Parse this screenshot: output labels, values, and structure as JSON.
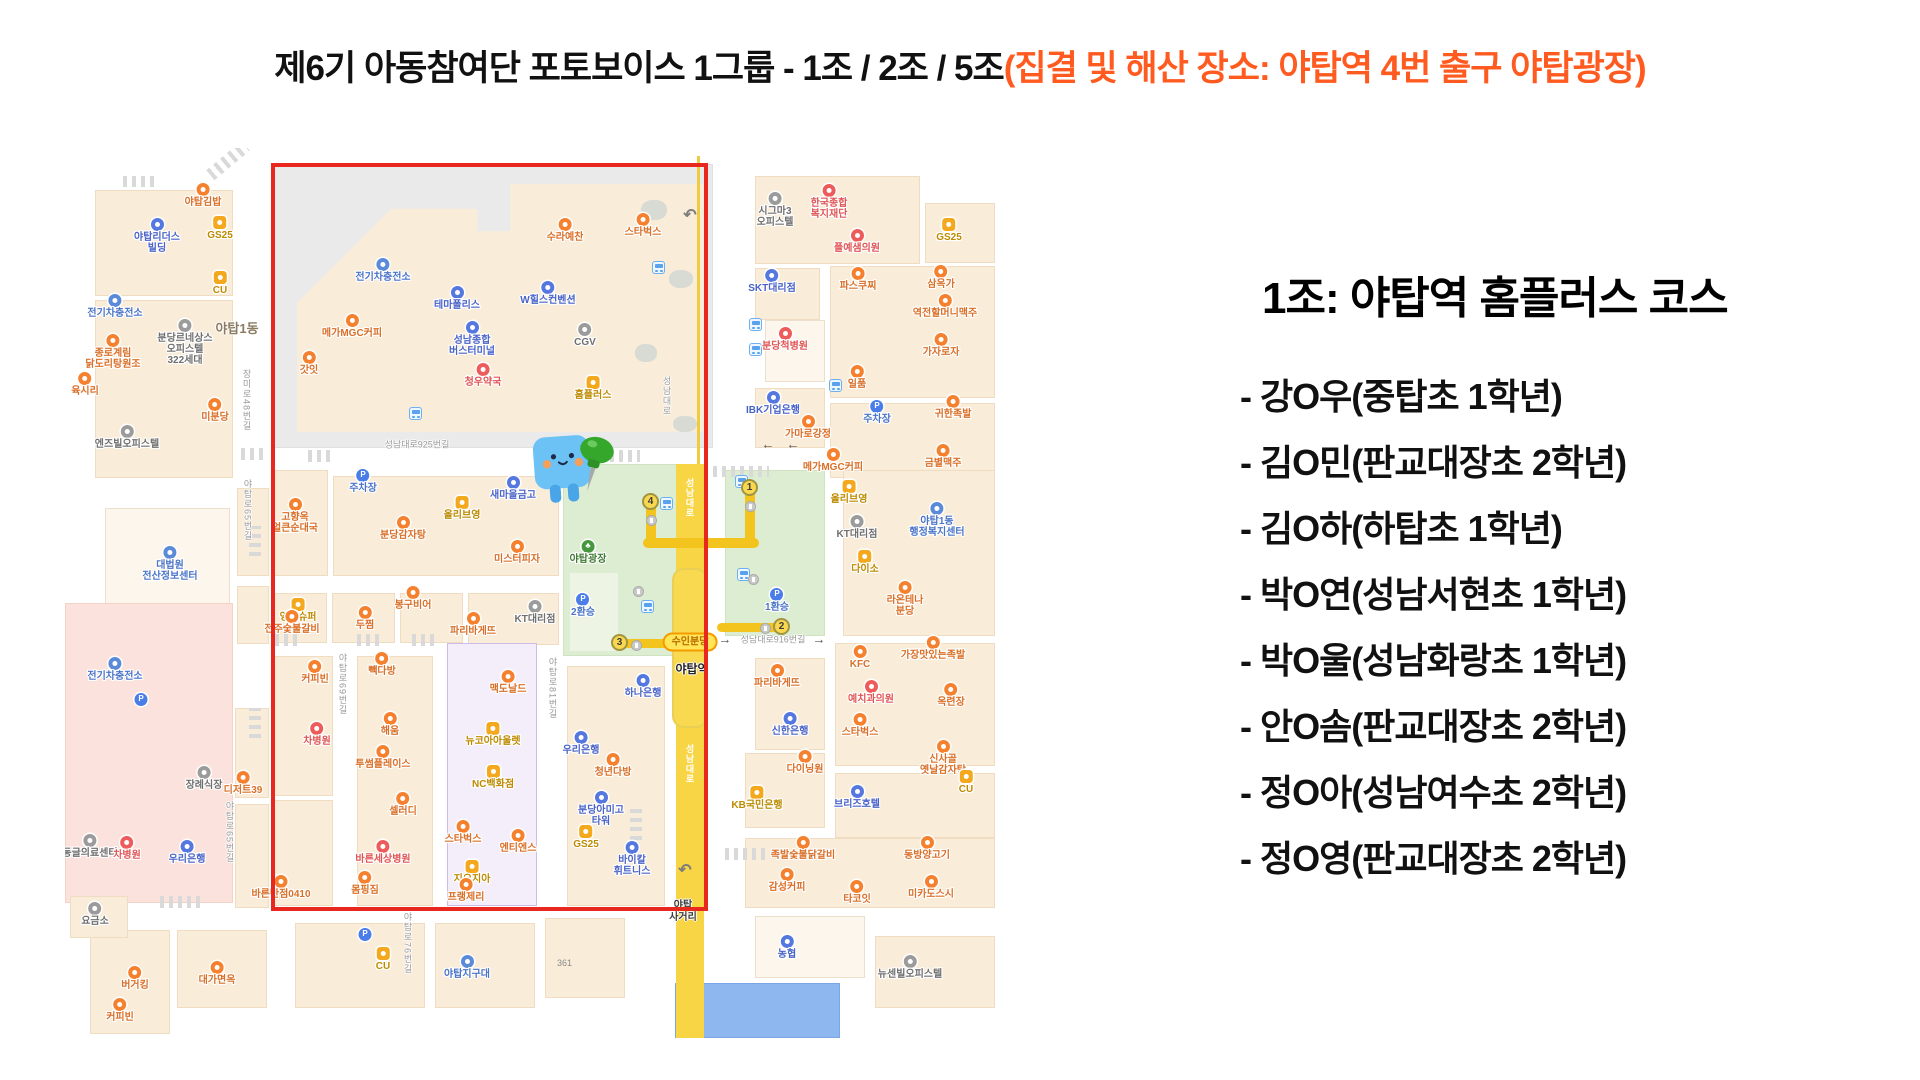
{
  "slide": {
    "title_black": "제6기 아동참여단 포토보이스 1그룹 - 1조 / 2조 / 5조",
    "title_orange": "(집결 및 해산 장소: 야탑역 4번 출구 야탑광장)",
    "title_orange_color": "#ff5a1f"
  },
  "panel": {
    "heading": "1조: 야탑역 홈플러스 코스",
    "members": [
      "- 강O우(중탑초 1학년)",
      "- 김O민(판교대장초 2학년)",
      "- 김O하(하탑초 1학년)",
      "- 박O연(성남서현초 1학년)",
      "- 박O울(성남화랑초 1학년)",
      "- 안O솜(판교대장초 2학년)",
      "- 정O아(성남여수초 2학년)",
      "- 정O영(판교대장초 2학년)"
    ]
  },
  "map": {
    "colors": {
      "highlight_box_red": "#e8281e",
      "road_yellow": "#f7d544",
      "route_yellow": "#f2c41d",
      "plaza_green": "#dcedd2",
      "block_beige": "#f9ecd9"
    },
    "station": {
      "line_badge": "수인분당",
      "name": "야탑역",
      "road_name": "성남대로"
    },
    "exits": [
      {
        "n": "4",
        "x": 586,
        "y": 354
      },
      {
        "n": "1",
        "x": 685,
        "y": 340
      },
      {
        "n": "3",
        "x": 555,
        "y": 495
      },
      {
        "n": "2",
        "x": 717,
        "y": 479
      }
    ],
    "route_segments": [
      [
        581,
        352,
        10,
        48
      ],
      [
        680,
        338,
        10,
        62
      ],
      [
        578,
        390,
        116,
        10
      ],
      [
        558,
        491,
        56,
        9
      ],
      [
        652,
        475,
        64,
        9
      ]
    ],
    "roads": [
      {
        "label": "성남대로925번길",
        "x": 352,
        "y": 296,
        "v": false
      },
      {
        "label": "성남대로916번길",
        "x": 708,
        "y": 491,
        "v": false
      },
      {
        "label": "장미로48번길",
        "x": 182,
        "y": 252,
        "v": true
      },
      {
        "label": "야탑로65번길",
        "x": 183,
        "y": 362,
        "v": true
      },
      {
        "label": "야탑로65번길",
        "x": 165,
        "y": 684,
        "v": true
      },
      {
        "label": "야탑로69번길",
        "x": 278,
        "y": 536,
        "v": true
      },
      {
        "label": "야탑로81번길",
        "x": 488,
        "y": 540,
        "v": true
      },
      {
        "label": "야탑로76번길",
        "x": 343,
        "y": 795,
        "v": true
      },
      {
        "label": "성남대로",
        "x": 602,
        "y": 248,
        "v": true
      }
    ],
    "arrows": [
      {
        "t": "←",
        "x": 703,
        "y": 296
      },
      {
        "t": "←",
        "x": 728,
        "y": 296
      },
      {
        "t": "→",
        "x": 660,
        "y": 491
      },
      {
        "t": "→",
        "x": 754,
        "y": 491
      }
    ],
    "dong_labels": [
      {
        "label": "야탑1동",
        "x": 172,
        "y": 170
      }
    ],
    "crossing_labels": [
      {
        "label": "야탑\n사거리",
        "x": 618,
        "y": 752
      }
    ],
    "number_labels": [
      {
        "label": "361",
        "x": 492,
        "y": 810
      }
    ],
    "pois": [
      {
        "label": "야탑김밥",
        "x": 138,
        "y": 49,
        "c": "food"
      },
      {
        "label": "야탑리더스\n빌딩",
        "x": 92,
        "y": 84,
        "c": "bank"
      },
      {
        "label": "GS25",
        "x": 155,
        "y": 82,
        "c": "conv"
      },
      {
        "label": "CU",
        "x": 155,
        "y": 137,
        "c": "conv"
      },
      {
        "label": "전기차충전소",
        "x": 50,
        "y": 160,
        "c": "pub"
      },
      {
        "label": "분당르네상스\n오피스텔\n322세대",
        "x": 120,
        "y": 185,
        "c": "grayp"
      },
      {
        "label": "종로계림\n닭도리탕원조",
        "x": 48,
        "y": 200,
        "c": "food"
      },
      {
        "label": "육시리",
        "x": 20,
        "y": 238,
        "c": "food"
      },
      {
        "label": "미분당",
        "x": 150,
        "y": 264,
        "c": "food"
      },
      {
        "label": "엔즈빌오피스텔",
        "x": 62,
        "y": 291,
        "c": "grayp"
      },
      {
        "label": "대법원\n전산정보센터",
        "x": 105,
        "y": 412,
        "c": "pub"
      },
      {
        "label": "전기차충전소",
        "x": 50,
        "y": 523,
        "c": "pub"
      },
      {
        "label": "",
        "x": 76,
        "y": 559,
        "c": "park",
        "g": "P"
      },
      {
        "label": "장례식장",
        "x": 139,
        "y": 632,
        "c": "grayp"
      },
      {
        "label": "동글의료센터",
        "x": 25,
        "y": 700,
        "c": "grayp"
      },
      {
        "label": "차병원",
        "x": 62,
        "y": 702,
        "c": "hosp"
      },
      {
        "label": "우리은행",
        "x": 122,
        "y": 706,
        "c": "bank"
      },
      {
        "label": "요금소",
        "x": 30,
        "y": 768,
        "c": "grayp"
      },
      {
        "label": "버거킹",
        "x": 70,
        "y": 832,
        "c": "food"
      },
      {
        "label": "대가면옥",
        "x": 152,
        "y": 827,
        "c": "food"
      },
      {
        "label": "커피빈",
        "x": 55,
        "y": 864,
        "c": "food"
      },
      {
        "label": "수라예찬",
        "x": 500,
        "y": 84,
        "c": "food"
      },
      {
        "label": "전기차충전소",
        "x": 318,
        "y": 124,
        "c": "pub"
      },
      {
        "label": "테마폴리스",
        "x": 392,
        "y": 152,
        "c": "bank"
      },
      {
        "label": "W힐스컨벤션",
        "x": 483,
        "y": 147,
        "c": "bank"
      },
      {
        "label": "메가MGC커피",
        "x": 287,
        "y": 180,
        "c": "food"
      },
      {
        "label": "성남종합\n버스터미널",
        "x": 407,
        "y": 187,
        "c": "bank"
      },
      {
        "label": "CGV",
        "x": 520,
        "y": 189,
        "c": "grayp"
      },
      {
        "label": "갓잇",
        "x": 244,
        "y": 217,
        "c": "food"
      },
      {
        "label": "청우약국",
        "x": 418,
        "y": 229,
        "c": "hosp"
      },
      {
        "label": "홈플러스",
        "x": 528,
        "y": 242,
        "c": "conv"
      },
      {
        "label": "스타벅스",
        "x": 578,
        "y": 79,
        "c": "food"
      },
      {
        "label": "주차장",
        "x": 298,
        "y": 335,
        "c": "park",
        "g": "P"
      },
      {
        "label": "새마을금고",
        "x": 448,
        "y": 342,
        "c": "bank"
      },
      {
        "label": "올리브영",
        "x": 397,
        "y": 362,
        "c": "conv"
      },
      {
        "label": "고향옥\n얼큰순대국",
        "x": 230,
        "y": 364,
        "c": "food"
      },
      {
        "label": "분당감자탕",
        "x": 338,
        "y": 382,
        "c": "food"
      },
      {
        "label": "미스터피자",
        "x": 452,
        "y": 406,
        "c": "food"
      },
      {
        "label": "야탑광장",
        "x": 523,
        "y": 406,
        "c": "plaza",
        "g": "♣"
      },
      {
        "label": "2환승",
        "x": 518,
        "y": 459,
        "c": "park",
        "g": "P"
      },
      {
        "label": "KT대리점",
        "x": 470,
        "y": 466,
        "c": "grayp"
      },
      {
        "label": "영진슈퍼",
        "x": 233,
        "y": 464,
        "c": "conv"
      },
      {
        "label": "봉구비어",
        "x": 348,
        "y": 452,
        "c": "food"
      },
      {
        "label": "전주숯불갈비",
        "x": 227,
        "y": 476,
        "c": "food"
      },
      {
        "label": "두찜",
        "x": 300,
        "y": 472,
        "c": "food"
      },
      {
        "label": "파리바게뜨",
        "x": 408,
        "y": 478,
        "c": "food"
      },
      {
        "label": "커피빈",
        "x": 250,
        "y": 526,
        "c": "food"
      },
      {
        "label": "빽다방",
        "x": 317,
        "y": 518,
        "c": "food"
      },
      {
        "label": "맥도날드",
        "x": 443,
        "y": 536,
        "c": "food"
      },
      {
        "label": "차병원",
        "x": 252,
        "y": 588,
        "c": "hosp"
      },
      {
        "label": "해움",
        "x": 325,
        "y": 578,
        "c": "food"
      },
      {
        "label": "투썸플레이스",
        "x": 318,
        "y": 611,
        "c": "food"
      },
      {
        "label": "디저트39",
        "x": 178,
        "y": 637,
        "c": "food"
      },
      {
        "label": "셀러디",
        "x": 338,
        "y": 658,
        "c": "food"
      },
      {
        "label": "뉴코아아울렛",
        "x": 428,
        "y": 588,
        "c": "conv"
      },
      {
        "label": "NC백화점",
        "x": 428,
        "y": 631,
        "c": "conv"
      },
      {
        "label": "스타벅스",
        "x": 398,
        "y": 686,
        "c": "food"
      },
      {
        "label": "엔티엔스",
        "x": 453,
        "y": 695,
        "c": "food"
      },
      {
        "label": "바른세상병원",
        "x": 318,
        "y": 706,
        "c": "hosp"
      },
      {
        "label": "지오지아",
        "x": 407,
        "y": 726,
        "c": "conv"
      },
      {
        "label": "몸핑짐",
        "x": 300,
        "y": 737,
        "c": "food"
      },
      {
        "label": "바른반점0410",
        "x": 216,
        "y": 741,
        "c": "food"
      },
      {
        "label": "프랭제리",
        "x": 401,
        "y": 744,
        "c": "food"
      },
      {
        "label": "우리은행",
        "x": 516,
        "y": 597,
        "c": "bank"
      },
      {
        "label": "하나은행",
        "x": 578,
        "y": 540,
        "c": "bank"
      },
      {
        "label": "청년다방",
        "x": 548,
        "y": 619,
        "c": "food"
      },
      {
        "label": "분당아미고\n타워",
        "x": 536,
        "y": 657,
        "c": "bank"
      },
      {
        "label": "GS25",
        "x": 521,
        "y": 691,
        "c": "conv"
      },
      {
        "label": "바이칼\n휘트니스",
        "x": 567,
        "y": 707,
        "c": "bank"
      },
      {
        "label": "시그마3\n오피스텔",
        "x": 710,
        "y": 58,
        "c": "grayp"
      },
      {
        "label": "한국종합\n복지재단",
        "x": 764,
        "y": 50,
        "c": "hosp"
      },
      {
        "label": "플예샘의원",
        "x": 792,
        "y": 95,
        "c": "hosp"
      },
      {
        "label": "GS25",
        "x": 884,
        "y": 84,
        "c": "conv"
      },
      {
        "label": "SKT대리점",
        "x": 707,
        "y": 135,
        "c": "bank"
      },
      {
        "label": "파스쿠찌",
        "x": 793,
        "y": 133,
        "c": "food"
      },
      {
        "label": "삼옥가",
        "x": 876,
        "y": 131,
        "c": "food"
      },
      {
        "label": "역전할머니맥주",
        "x": 880,
        "y": 160,
        "c": "food"
      },
      {
        "label": "분당척병원",
        "x": 720,
        "y": 193,
        "c": "hosp"
      },
      {
        "label": "가자로자",
        "x": 876,
        "y": 199,
        "c": "food"
      },
      {
        "label": "일품",
        "x": 792,
        "y": 231,
        "c": "food"
      },
      {
        "label": "IBK기업은행",
        "x": 708,
        "y": 257,
        "c": "bank"
      },
      {
        "label": "가마로강정",
        "x": 743,
        "y": 281,
        "c": "food"
      },
      {
        "label": "주차장",
        "x": 812,
        "y": 266,
        "c": "park",
        "g": "P"
      },
      {
        "label": "귀한족발",
        "x": 888,
        "y": 261,
        "c": "food"
      },
      {
        "label": "금별맥주",
        "x": 878,
        "y": 310,
        "c": "food"
      },
      {
        "label": "메가MGC커피",
        "x": 768,
        "y": 314,
        "c": "food"
      },
      {
        "label": "올리브영",
        "x": 784,
        "y": 346,
        "c": "conv"
      },
      {
        "label": "KT대리점",
        "x": 792,
        "y": 381,
        "c": "grayp"
      },
      {
        "label": "야탑1동\n행정복지센터",
        "x": 872,
        "y": 368,
        "c": "pub"
      },
      {
        "label": "다이소",
        "x": 800,
        "y": 416,
        "c": "conv"
      },
      {
        "label": "라온테나\n분당",
        "x": 840,
        "y": 447,
        "c": "food"
      },
      {
        "label": "1환승",
        "x": 712,
        "y": 454,
        "c": "park",
        "g": "P"
      },
      {
        "label": "KFC",
        "x": 795,
        "y": 511,
        "c": "food"
      },
      {
        "label": "가장맛있는족발",
        "x": 868,
        "y": 502,
        "c": "food"
      },
      {
        "label": "예치과의원",
        "x": 806,
        "y": 546,
        "c": "hosp"
      },
      {
        "label": "옥련장",
        "x": 886,
        "y": 549,
        "c": "food"
      },
      {
        "label": "스타벅스",
        "x": 795,
        "y": 579,
        "c": "food"
      },
      {
        "label": "신사골\n옛날감자탕",
        "x": 878,
        "y": 606,
        "c": "food"
      },
      {
        "label": "파리바게뜨",
        "x": 712,
        "y": 530,
        "c": "food"
      },
      {
        "label": "신한은행",
        "x": 725,
        "y": 578,
        "c": "bank"
      },
      {
        "label": "다이닝원",
        "x": 740,
        "y": 616,
        "c": "food"
      },
      {
        "label": "KB국민은행",
        "x": 692,
        "y": 652,
        "c": "conv"
      },
      {
        "label": "브리즈호텔",
        "x": 792,
        "y": 651,
        "c": "bank"
      },
      {
        "label": "CU",
        "x": 901,
        "y": 636,
        "c": "conv"
      },
      {
        "label": "족발숯불닭갈비",
        "x": 738,
        "y": 702,
        "c": "food"
      },
      {
        "label": "동방양고기",
        "x": 862,
        "y": 702,
        "c": "food"
      },
      {
        "label": "감성커피",
        "x": 722,
        "y": 734,
        "c": "food"
      },
      {
        "label": "타코잇",
        "x": 792,
        "y": 746,
        "c": "food"
      },
      {
        "label": "미카도스시",
        "x": 866,
        "y": 741,
        "c": "food"
      },
      {
        "label": "농협",
        "x": 722,
        "y": 801,
        "c": "bank"
      },
      {
        "label": "뉴센빌오피스텔",
        "x": 845,
        "y": 821,
        "c": "grayp"
      },
      {
        "label": "",
        "x": 300,
        "y": 794,
        "c": "park",
        "g": "P"
      },
      {
        "label": "CU",
        "x": 318,
        "y": 813,
        "c": "conv"
      },
      {
        "label": "야탑지구대",
        "x": 402,
        "y": 821,
        "c": "pub"
      }
    ],
    "bus_icons": [
      [
        350,
        265
      ],
      [
        593,
        119
      ],
      [
        601,
        355
      ],
      [
        690,
        176
      ],
      [
        690,
        201
      ],
      [
        676,
        333
      ],
      [
        678,
        426
      ],
      [
        582,
        458
      ],
      [
        770,
        237
      ]
    ],
    "stair_icons": [
      [
        586,
        372
      ],
      [
        685,
        358
      ],
      [
        571,
        497
      ],
      [
        700,
        480
      ],
      [
        573,
        443
      ],
      [
        688,
        431
      ]
    ],
    "uturn_arrows": [
      [
        625,
        67
      ],
      [
        620,
        722
      ]
    ]
  }
}
